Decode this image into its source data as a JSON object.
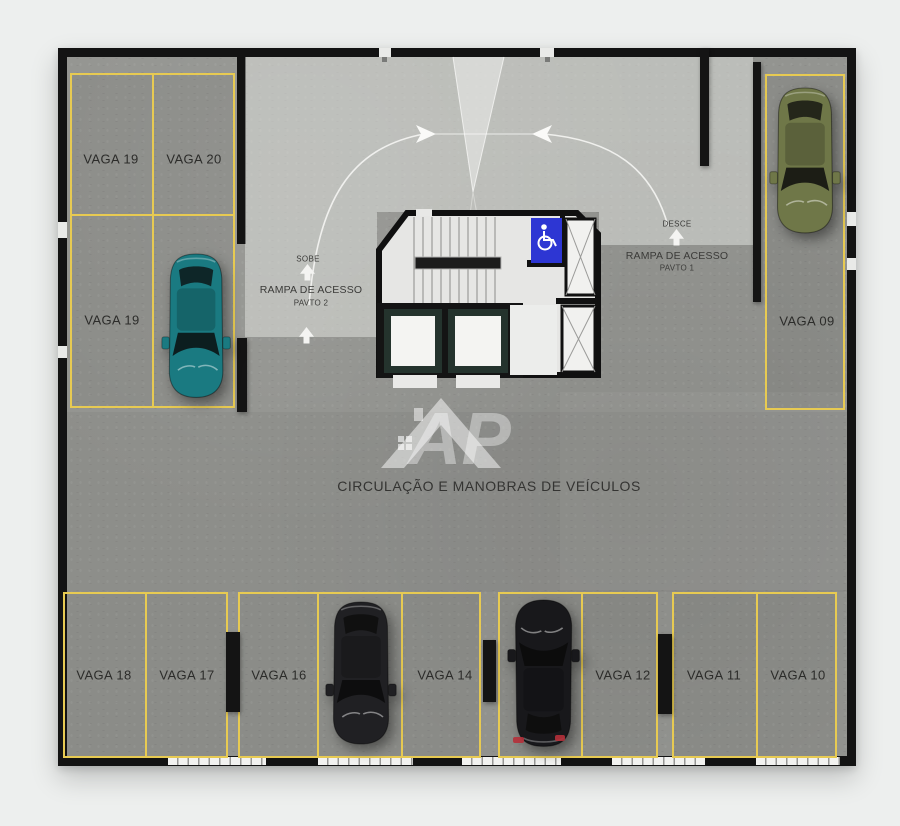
{
  "plan": {
    "circulation_label": "CIRCULAÇÃO E MANOBRAS DE VEÍCULOS",
    "watermark_text": "AP",
    "ramp_left": {
      "flow": "SOBE",
      "name": "RAMPA DE ACESSO",
      "level": "PAVTO 2"
    },
    "ramp_right": {
      "flow": "DESCE",
      "name": "RAMPA DE ACESSO",
      "level": "PAVTO 1"
    },
    "stalls": {
      "top_left_upper_1": "VAGA 19",
      "top_left_upper_2": "VAGA 20",
      "top_left_lower": "VAGA 19",
      "right_column": "VAGA 09",
      "bottom_1": "VAGA 18",
      "bottom_2": "VAGA 17",
      "bottom_3": "VAGA 16",
      "bottom_4": "VAGA 14",
      "bottom_5": "VAGA 12",
      "bottom_6": "VAGA 11",
      "bottom_7": "VAGA 10"
    },
    "icons": {
      "accessibility_sign": "wheelchair-icon",
      "direction_arrow": "arrow-up-icon"
    },
    "cars": [
      {
        "color_name": "teal",
        "hex": "#1a7a81"
      },
      {
        "color_name": "olive",
        "hex": "#6f7748"
      },
      {
        "color_name": "black",
        "hex": "#202023"
      },
      {
        "color_name": "black",
        "hex": "#18181b"
      }
    ],
    "colors": {
      "stall_line_yellow": "#e7ca52",
      "accessibility_blue": "#2d36d3",
      "wall_black": "#131313",
      "floor_gray": "#939490",
      "background": "#edefee"
    }
  }
}
